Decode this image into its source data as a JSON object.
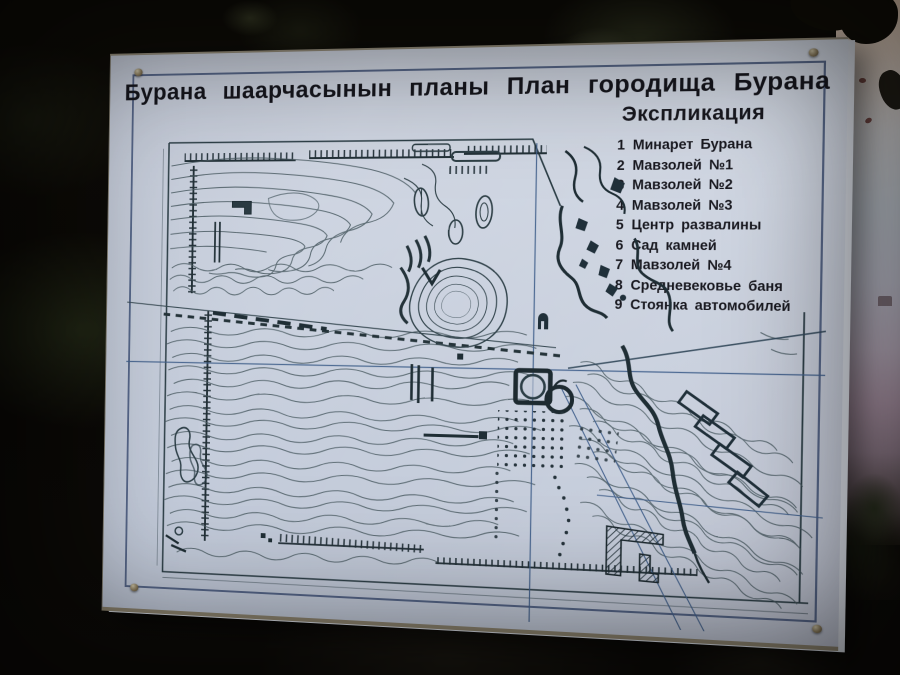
{
  "sign": {
    "title": "Бурана шаарчасынын планы План городища Бурана",
    "legend": {
      "title": "Экспликация",
      "items": [
        {
          "num": "1",
          "label": "Минарет Бурана"
        },
        {
          "num": "2",
          "label": "Мавзолей №1"
        },
        {
          "num": "3",
          "label": "Мавзолей №2"
        },
        {
          "num": "4",
          "label": "Мавзолей №3"
        },
        {
          "num": "5",
          "label": "Центр развалины"
        },
        {
          "num": "6",
          "label": "Сад камней"
        },
        {
          "num": "7",
          "label": "Мавзолей №4"
        },
        {
          "num": "8",
          "label": "Средневековье баня"
        },
        {
          "num": "9",
          "label": "Стоянка автомобилей"
        }
      ]
    },
    "map": {
      "symbols": [
        "city-rampart-hatching",
        "contour-lines",
        "survey-grid-lines",
        "access-road",
        "central-mound",
        "minaret-base-symbol",
        "mausoleum-oval-symbols",
        "stone-garden-dot-grid",
        "parking-rectangles",
        "bathhouse-hatched-building",
        "stream-line",
        "pond-outline"
      ]
    }
  },
  "colors": {
    "board": "#c9d1de",
    "ink": "#16161d",
    "map_line": "#3d5058",
    "map_heavy": "#1f2e35",
    "map_blue": "#41608c",
    "sky_top": "#f4d8c0",
    "sky_mid": "#d9e0ea",
    "sky_mauve": "#c0a6ba",
    "foliage": "#0b0906"
  }
}
